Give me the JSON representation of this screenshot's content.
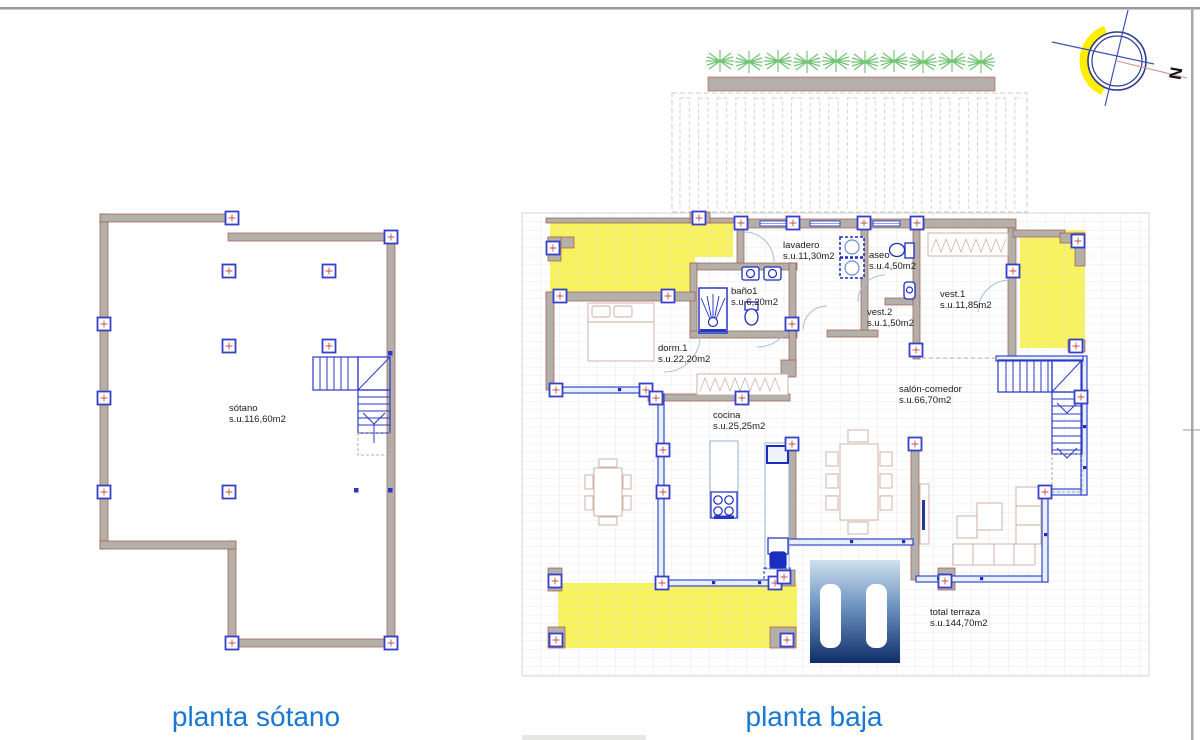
{
  "captions": {
    "left": "planta sótano",
    "right": "planta baja"
  },
  "plans": {
    "sotano": {
      "room": {
        "name": "sótano",
        "area": "s.u.116,60m2"
      }
    },
    "baja": {
      "rooms": [
        {
          "name": "lavadero",
          "area": "s.u.11,30m2"
        },
        {
          "name": "aseo",
          "area": "s.u.4,50m2"
        },
        {
          "name": "baño1",
          "area": "s.u.6,20m2"
        },
        {
          "name": "vest.2",
          "area": "s.u.1,50m2"
        },
        {
          "name": "vest.1",
          "area": "s.u.11,85m2"
        },
        {
          "name": "dorm.1",
          "area": "s.u.22,20m2"
        },
        {
          "name": "salón-comedor",
          "area": "s.u.66,70m2"
        },
        {
          "name": "cocina",
          "area": "s.u.25,25m2"
        },
        {
          "name": "total terraza",
          "area": "s.u.144,70m2"
        }
      ]
    }
  },
  "compass": {
    "north_label": "N"
  },
  "colors": {
    "accent_blue": "#1878d2",
    "terrace_yellow": "#f8f35c",
    "wall_gray": "#b3afa9",
    "plan_blue": "#2438c8",
    "plant_green": "#74c476",
    "pool_top": "#cfe0ee",
    "pool_bottom": "#0f2e68"
  }
}
